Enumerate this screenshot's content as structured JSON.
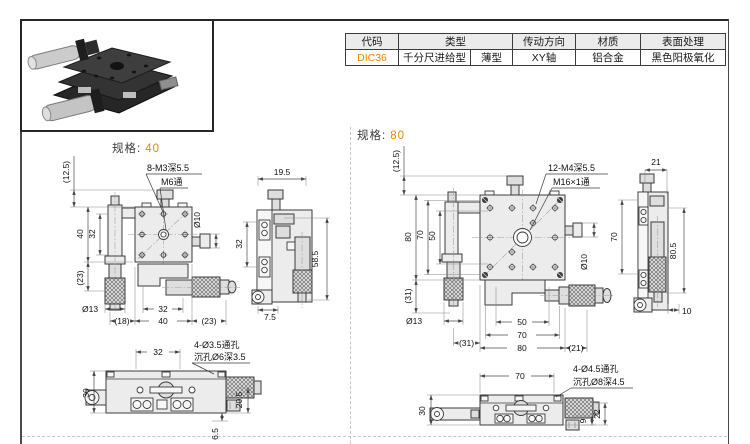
{
  "table": {
    "headers": {
      "code": "代码",
      "type": "类型",
      "direction": "传动方向",
      "material": "材质",
      "finish": "表面处理"
    },
    "row": {
      "code": "DIC36",
      "type_main": "千分尺进给型",
      "type_sub": "薄型",
      "direction": "XY轴",
      "material": "铝合金",
      "finish": "黑色阳极氧化"
    }
  },
  "accent_color": "#f08300",
  "spec40": {
    "label": "规格:",
    "value": "40",
    "front": {
      "callout_holes": "8-M3深5.5",
      "callout_center": "M6通",
      "dia_side": "Ø10",
      "dim_top_offset": "(12.5)",
      "dim_height": "40",
      "dim_inner_height": "32",
      "dim_below": "(23)",
      "dia_knob": "Ø13",
      "dim_left_ext": "(18)",
      "dim_inner_width": "32",
      "dim_width": "40",
      "dim_right_ext": "(23)"
    },
    "side": {
      "dim_top": "19.5",
      "dim_left": "32",
      "dim_right": "58.5",
      "dim_bottom": "7.5"
    },
    "bottom": {
      "callout_line1": "4-Ø3.5通孔",
      "callout_line2": "沉孔Ø6深3.5",
      "dim_width": "32",
      "dim_height": "30",
      "dim_right": "20.5",
      "dim_offset": "6.5"
    }
  },
  "spec80": {
    "label": "规格:",
    "value": "80",
    "front": {
      "callout_holes": "12-M4深5.5",
      "callout_center": "M16×1通",
      "dia_side": "Ø10",
      "dim_top_offset": "(12.5)",
      "dim_height": "80",
      "dim_inner_height": "70",
      "dim_hole_height": "50",
      "dim_below": "(31)",
      "dia_knob": "Ø13",
      "dim_left_ext": "(31)",
      "dim_hole_width": "50",
      "dim_inner_width": "70",
      "dim_width": "80",
      "dim_right_ext": "(21)"
    },
    "side": {
      "dim_top": "21",
      "dim_left": "70",
      "dim_right": "80.5",
      "dim_bottom": "10"
    },
    "bottom": {
      "callout_line1": "4-Ø4.5通孔",
      "callout_line2": "沉孔Ø8深4.5",
      "dim_width": "70",
      "dim_height": "30",
      "dim_screw": "9",
      "dim_right": "22"
    }
  }
}
